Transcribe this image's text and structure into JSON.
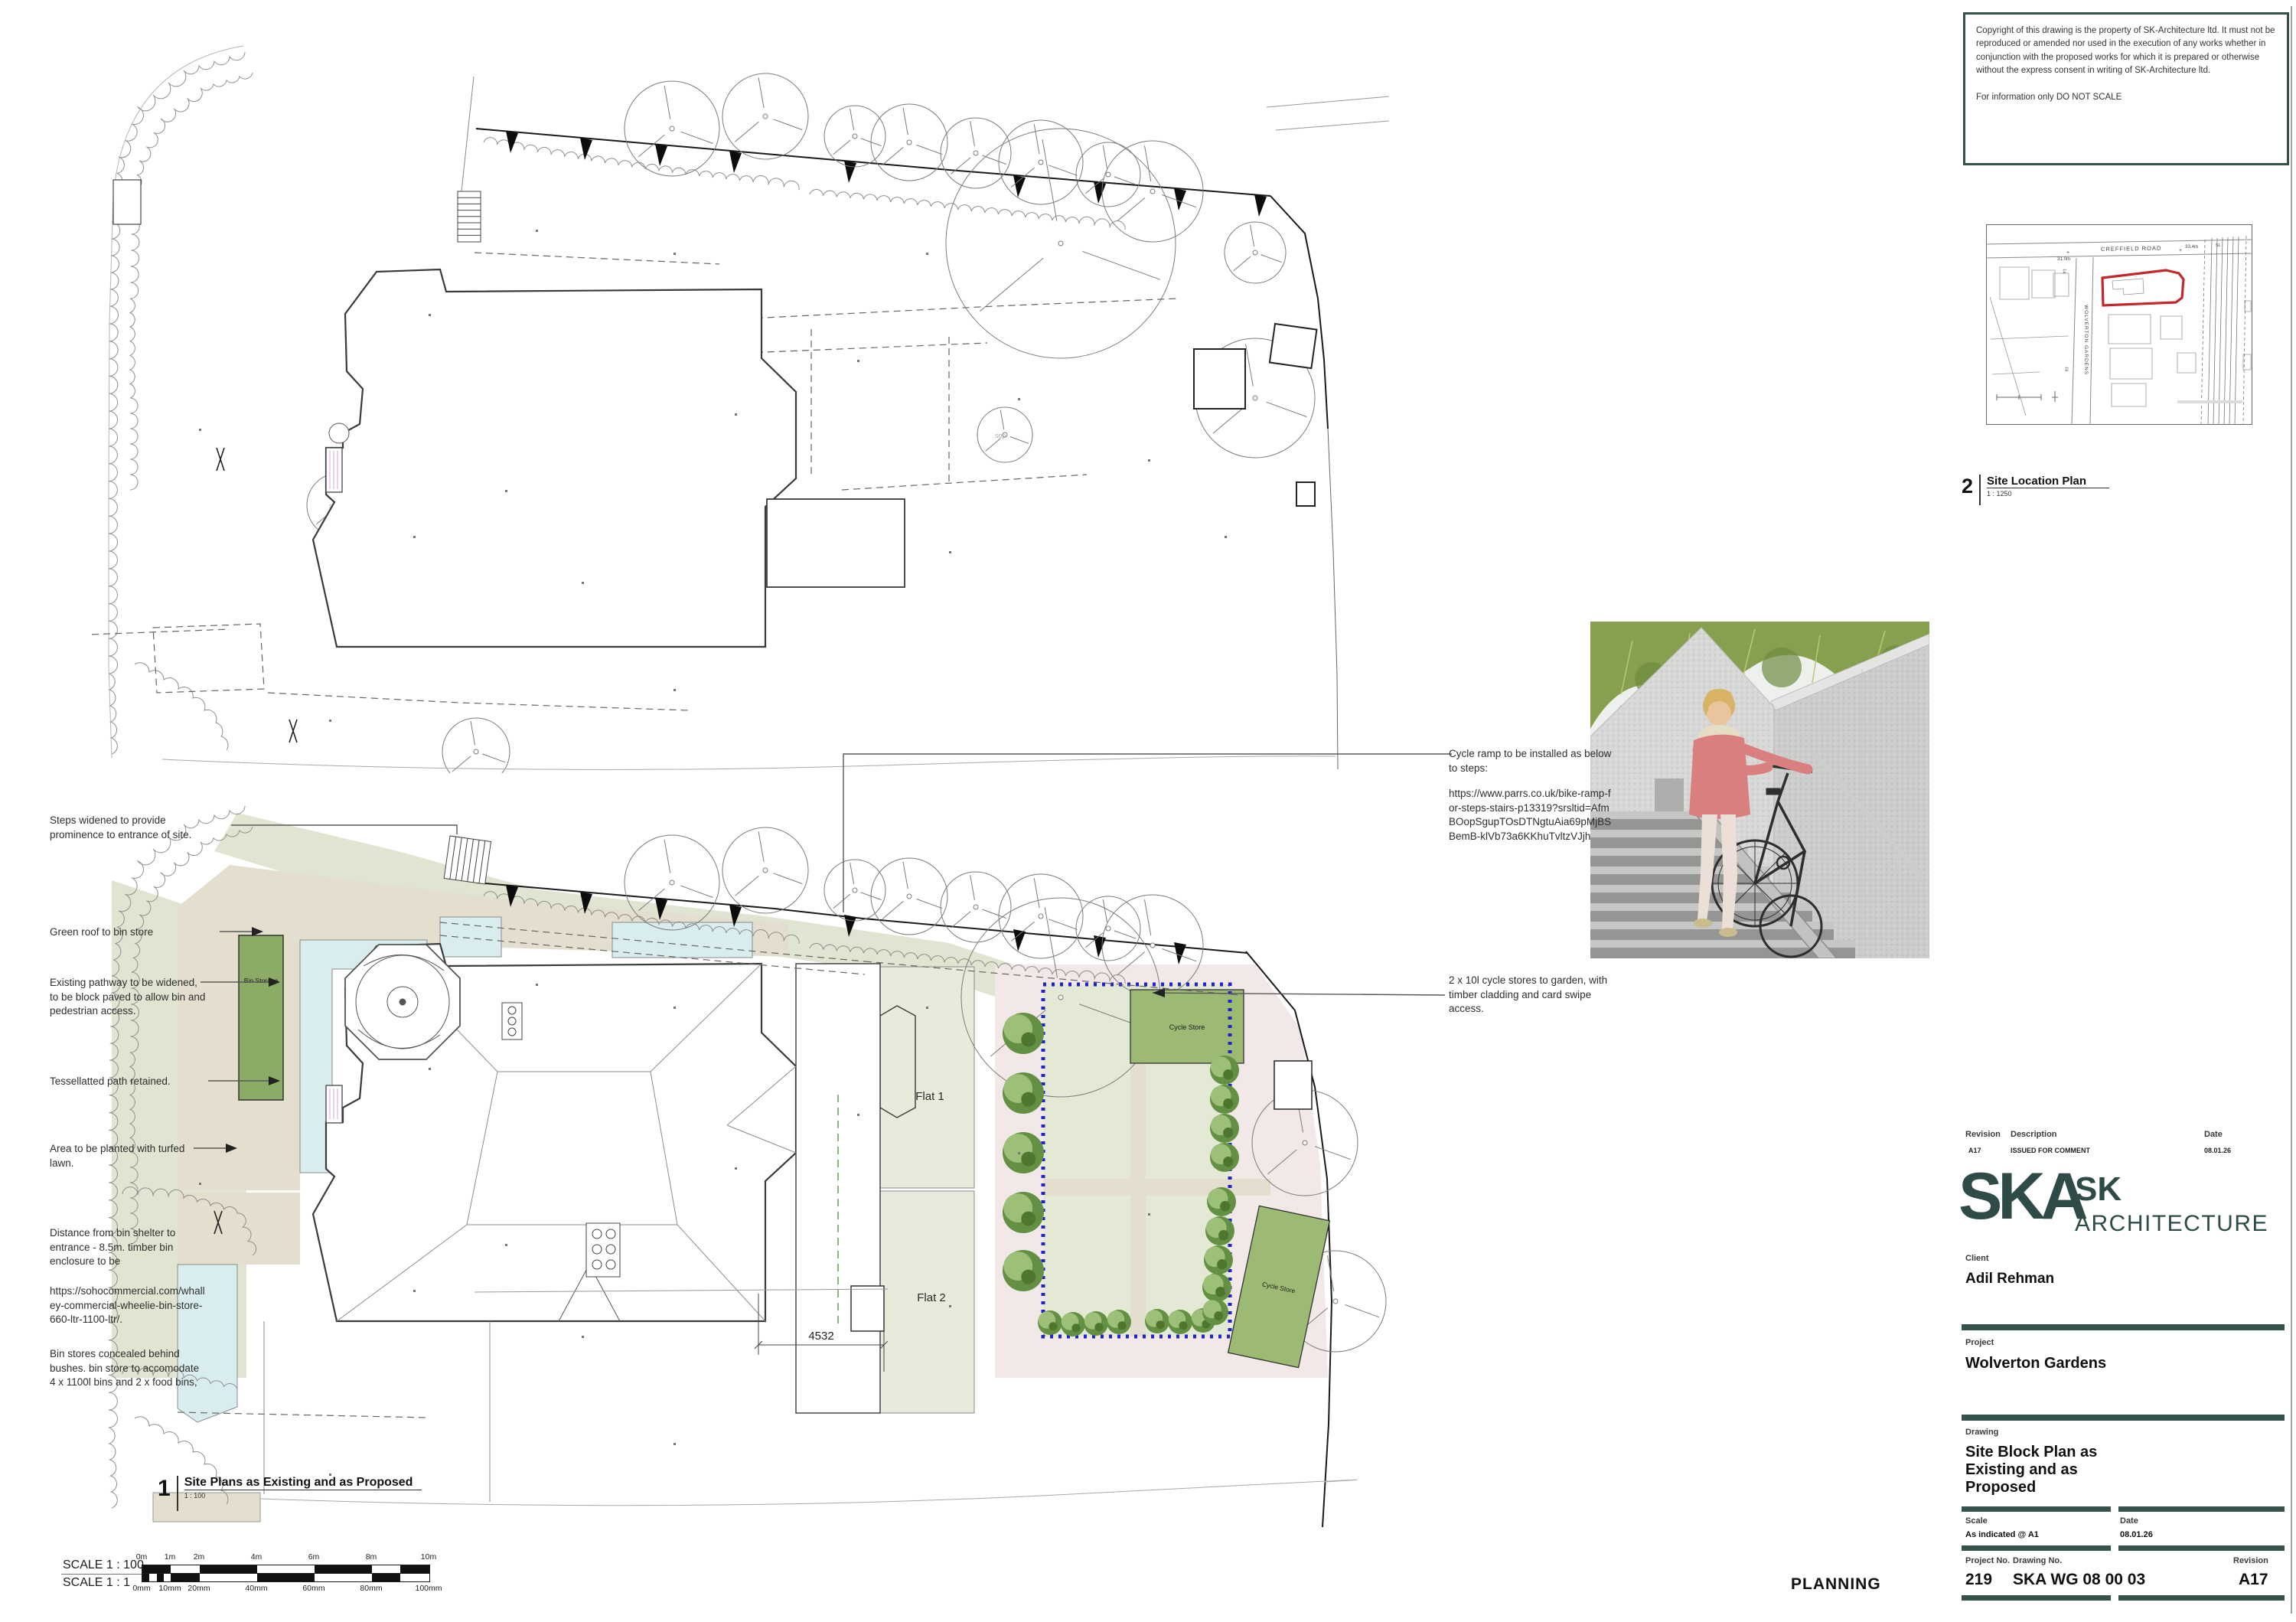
{
  "copyright_box": {
    "para1": "Copyright of this drawing is the property of SK-Architecture ltd.  It must not be reproduced or amended nor used in the execution of any works whether in conjunction with the proposed works for which it is prepared or otherwise without the express consent in writing of SK-Architecture ltd.",
    "para2": "For information only DO NOT SCALE"
  },
  "site_location": {
    "number": "2",
    "title": "Site Location Plan",
    "scale": "1 : 1250",
    "road": "CREFFIELD ROAD",
    "street": "WOLVERTON GARDENS",
    "level_left": "31.0m",
    "level_right": "33.4m",
    "sl": "SL",
    "house_14": "14",
    "house_19": "19"
  },
  "plan_main": {
    "number": "1",
    "title": "Site Plans as Existing and as Proposed",
    "scale": "1 : 100"
  },
  "plan_labels": {
    "bin_storage": "Bin Storage",
    "flat1": "Flat 1",
    "flat2": "Flat 2",
    "cycle_store1": "Cycle Store",
    "cycle_store2": "Cycle Store",
    "dim_4532": "4532",
    "sop": "sop"
  },
  "annotations_left": [
    "Steps widened to provide prominence to entrance of site.",
    "Green roof to bin store",
    "Existing pathway to be widened, to be block paved to allow bin and pedestrian access.",
    "Tessellatted path retained.",
    "Area to be planted with turfed lawn.",
    "Distance from bin shelter to entrance - 8.5m. timber bin enclosure to be",
    "https://sohocommercial.com/whalley-commercial-wheelie-bin-store-660-ltr-1100-ltr/.",
    "Bin stores concealed behind bushes. bin store to accomodate 4 x 1100l bins and 2 x food bins,"
  ],
  "annotations_right": [
    "Cycle ramp to be installed as below to steps:",
    "https://www.parrs.co.uk/bike-ramp-for-steps-stairs-p13319?srsltid=AfmBOopSgupTOsDTNgtuAia69pMjBSBemB-klVb73a6KKhuTvltzVJjh",
    "2 x 10l cycle stores to garden, with timber cladding and card swipe access."
  ],
  "scale_bars": {
    "label_100": "SCALE 1 : 100",
    "label_1": "SCALE 1 : 1",
    "ticks_m": [
      "0m",
      "1m",
      "2m",
      "4m",
      "6m",
      "8m",
      "10m"
    ],
    "ticks_mm": [
      "0mm",
      "10mm",
      "20mm",
      "40mm",
      "60mm",
      "80mm",
      "100mm"
    ]
  },
  "stamp": "PLANNING",
  "title_block": {
    "revision_header": "Revision",
    "description_header": "Description",
    "date_header": "Date",
    "revision_value": "A17",
    "description_value": "ISSUED FOR COMMENT",
    "date_value": "08.01.26",
    "logo_text": "SKA",
    "brand_line1": "SK",
    "brand_line2": "ARCHITECTURE",
    "client_label": "Client",
    "client_name": "Adil Rehman",
    "project_label": "Project",
    "project_name": "Wolverton Gardens",
    "drawing_label": "Drawing",
    "drawing_title": "Site Block Plan as Existing and as Proposed",
    "scale_label": "Scale",
    "scale_value": "As indicated @ A1",
    "date_label": "Date",
    "date_value2": "08.01.26",
    "project_no_label": "Project No.",
    "project_no": "219",
    "drawing_no_label": "Drawing No.",
    "drawing_no": "SKA WG 08 00 03",
    "revision_label": "Revision",
    "revision_value2": "A17"
  },
  "colors": {
    "teal": "#35524d",
    "site_outline_red": "#c3272b",
    "bin_green": "#8cab66",
    "cycle_green": "#9cba74",
    "sage": "#dfe5d1",
    "garden": "#e6ebdb",
    "dotted_garden": "#e3e9d5",
    "beige": "#e3decd",
    "cyan": "#d9edef",
    "pink": "#f2e8e8",
    "boundary_blue": "#2121cd"
  }
}
